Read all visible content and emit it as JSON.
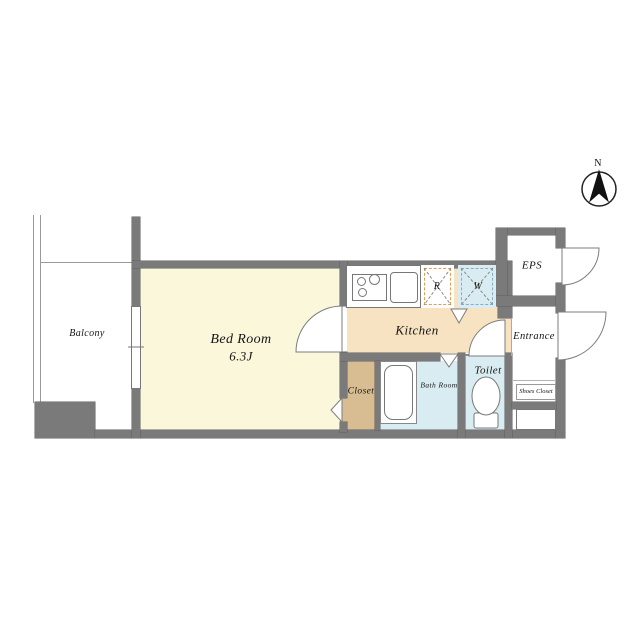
{
  "compass": {
    "label": "N"
  },
  "rooms": {
    "balcony": "Balcony",
    "bedroom_name": "Bed Room",
    "bedroom_size": "6.3J",
    "kitchen": "Kitchen",
    "closet": "Closet",
    "bathroom": "Bath Room",
    "toilet": "Toilet",
    "entrance": "Entrance",
    "eps": "EPS",
    "shoes_closet": "Shoes Closet"
  },
  "fixtures": {
    "refrigerator": "R",
    "washer": "W"
  },
  "colors": {
    "wall": "#7a7a7a",
    "bedroom_floor": "#FAF7DA",
    "kitchen_floor": "#F7E3C1",
    "closet_floor": "#D8BC92",
    "wet_area_floor": "#D9ECF1",
    "refrigerator_dash": "#DE9D5A",
    "washer_dash": "#86AECC"
  }
}
